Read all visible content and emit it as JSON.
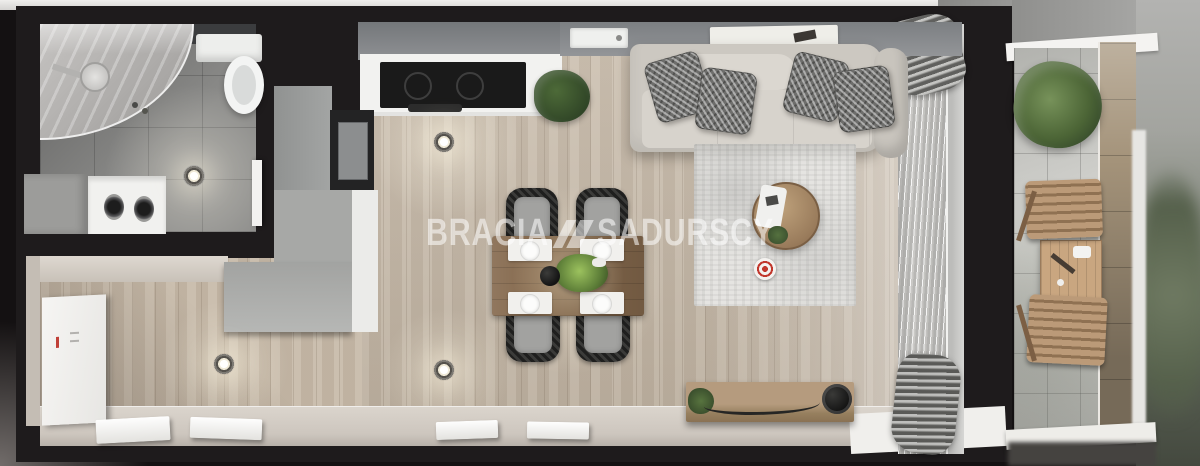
{
  "watermark": {
    "brand_left": "BRACIA",
    "brand_right": "SADURSCY",
    "logo": "double-slash-mark"
  },
  "palette": {
    "wall": "#1e1b1c",
    "wood_floor": "#c8bbaa",
    "bathroom_tile": "#8b8b89",
    "kitchen_white": "#f2f2f0",
    "cabinet_gray": "#a3a5a4",
    "cooktop_black": "#1a1a1a",
    "sofa": "#ccc8c1",
    "pillow": "#6e6e6c",
    "rug": "#e5e4e1",
    "dining_table_wood": "#84684c",
    "accent_red": "#c1372c",
    "plant_green": "#4d6a38",
    "curtain": "#cbcac7",
    "balcony_tile": "#d0d0cc",
    "balcony_wood": "#bb9a78",
    "watermark_color": "rgba(255,255,255,0.55)"
  },
  "scene_objects": [
    "shower",
    "toilet",
    "washer-dryer",
    "bathroom-cabinet",
    "entrance-door",
    "wardrobe",
    "kitchen-counter",
    "cooktop",
    "oven-column",
    "sink",
    "window-sill-trays",
    "kitchen-plant",
    "dining-table",
    "dining-chairs",
    "place-settings",
    "sofa",
    "pillows",
    "rug",
    "coffee-table",
    "red-stool",
    "tv-bench",
    "speaker",
    "curtain",
    "downlights",
    "doormats",
    "balcony-plant",
    "balcony-table",
    "balcony-chairs"
  ]
}
